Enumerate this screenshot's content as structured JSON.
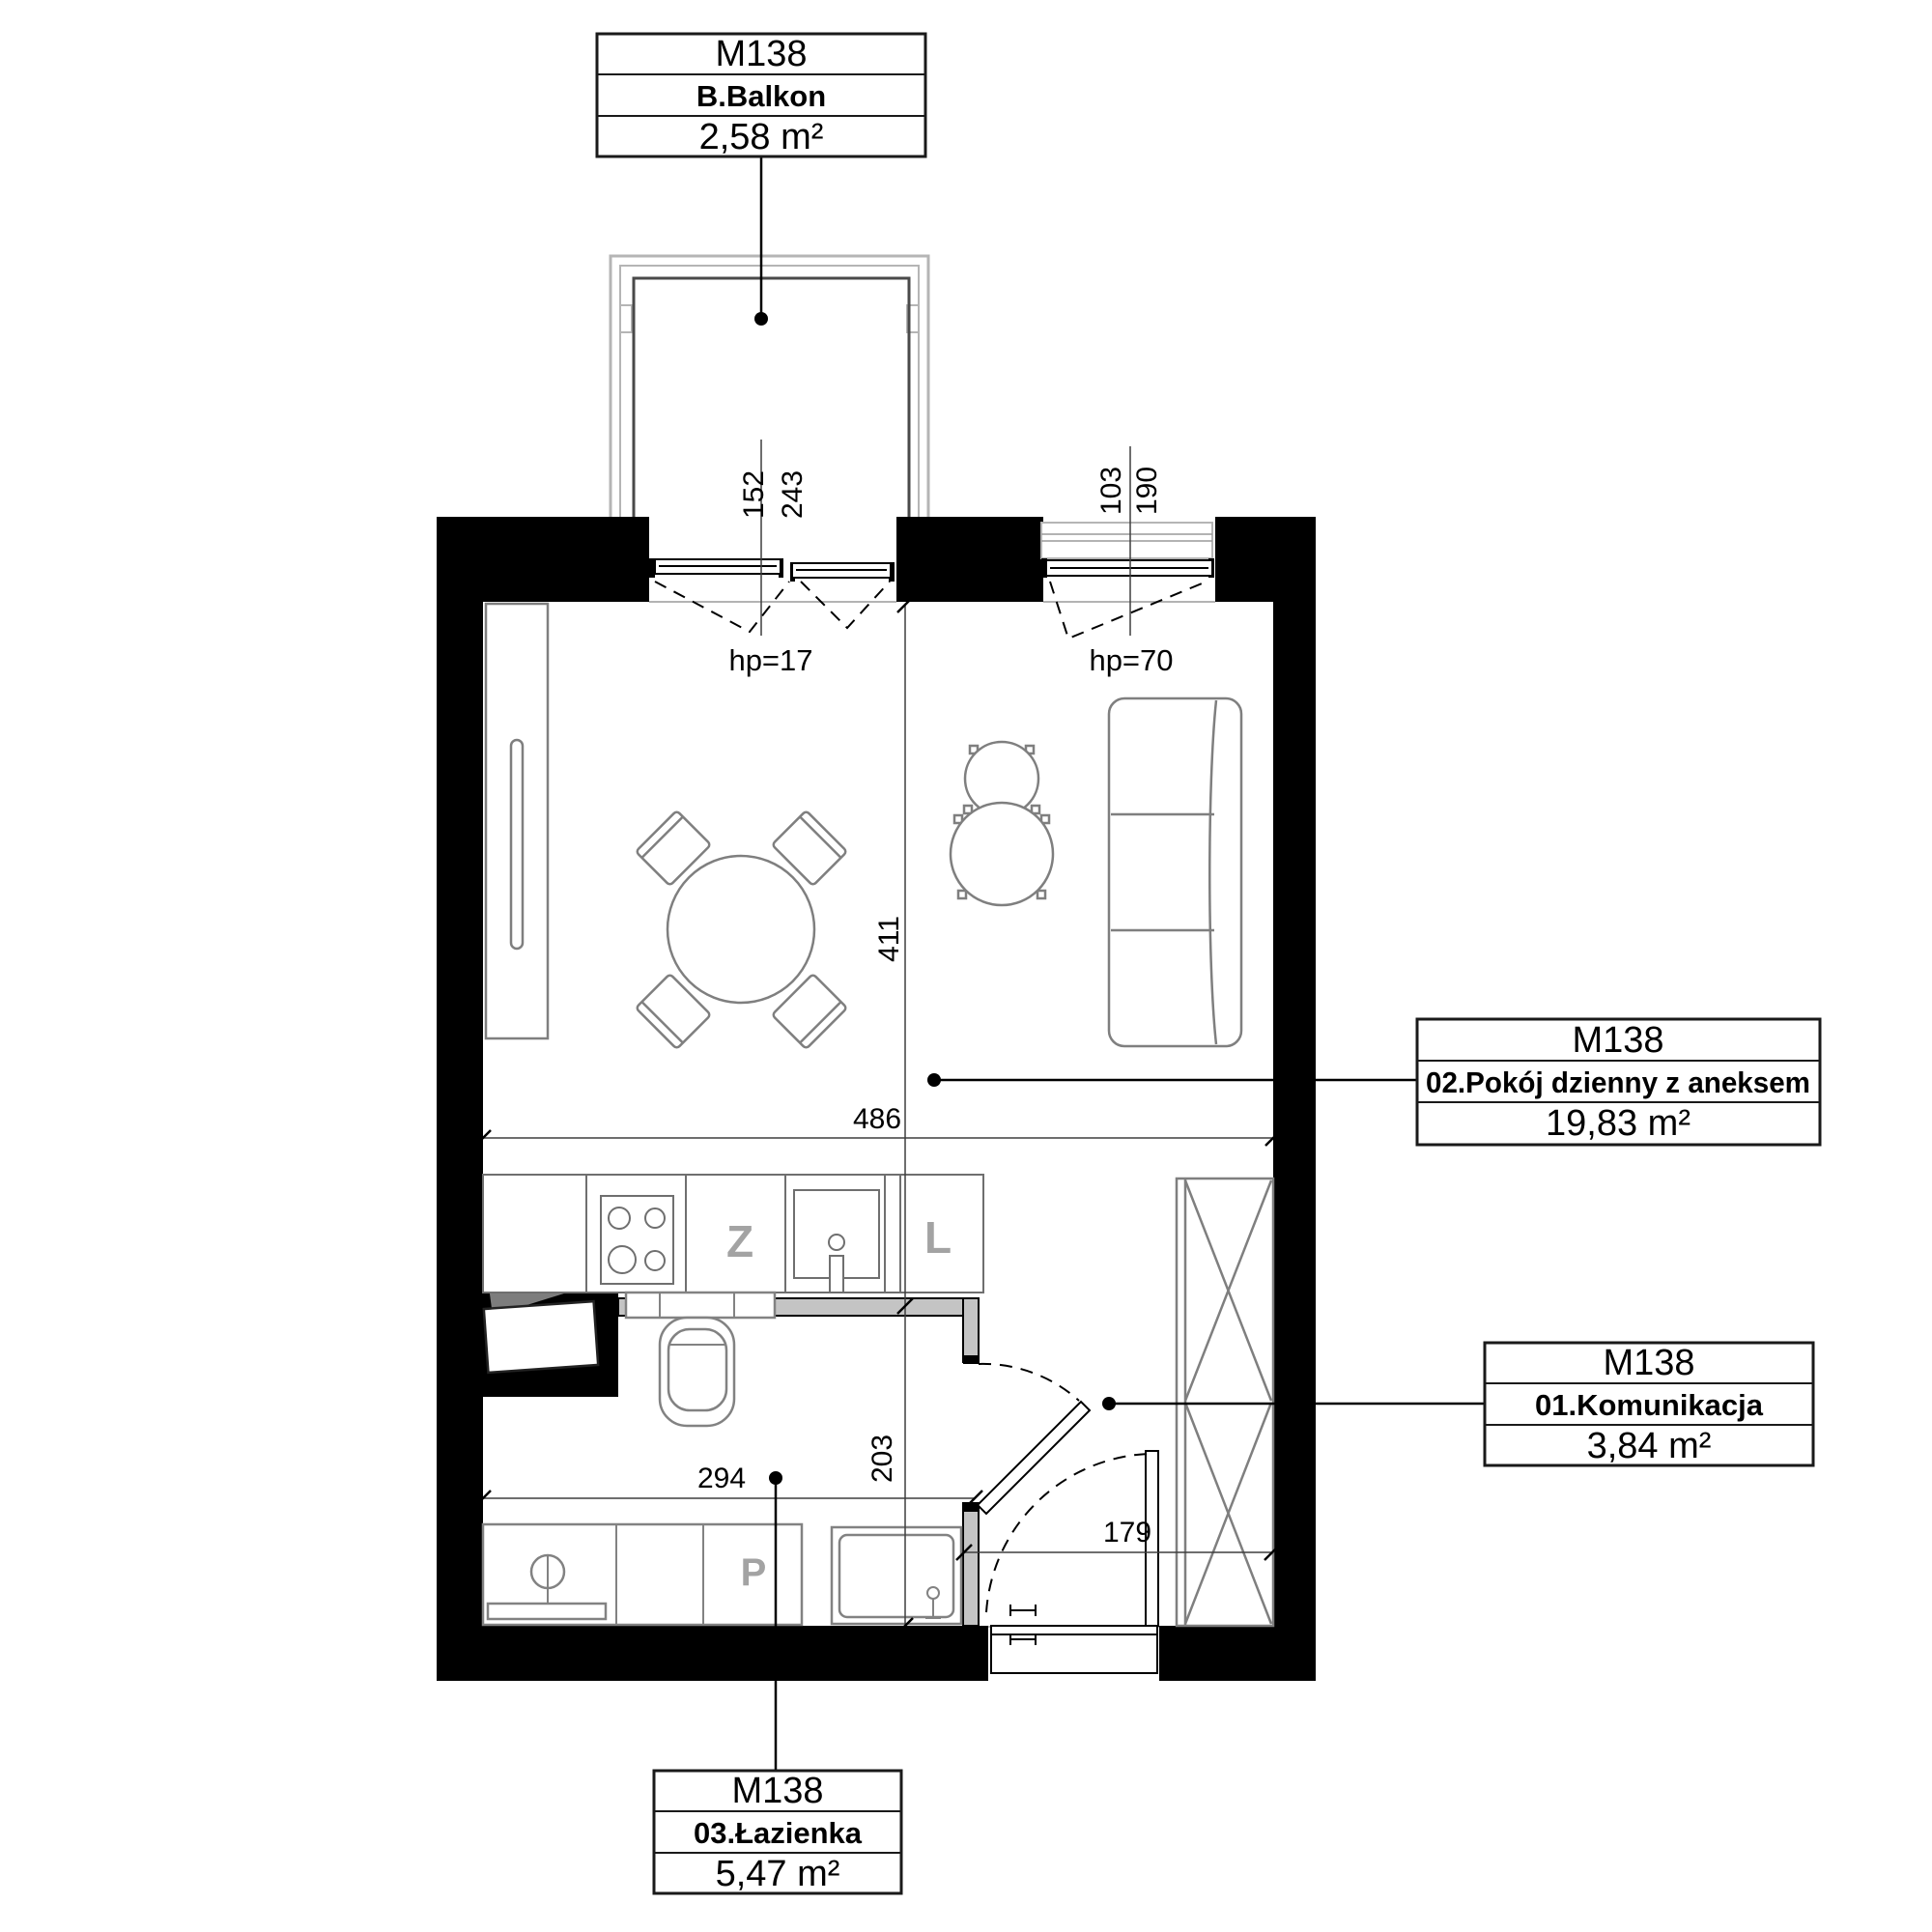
{
  "unit_label": "M138",
  "rooms": {
    "balcony": {
      "unit": "M138",
      "name": "B.Balkon",
      "area": "2,58 m²"
    },
    "living": {
      "unit": "M138",
      "name": "02.Pokój dzienny z aneksem",
      "area": "19,83 m²"
    },
    "hall": {
      "unit": "M138",
      "name": "01.Komunikacja",
      "area": "3,84 m²"
    },
    "bathroom": {
      "unit": "M138",
      "name": "03.Łazienka",
      "area": "5,47 m²"
    }
  },
  "dimensions": {
    "balcony_inner_width": "152",
    "balcony_outer_width": "243",
    "window_glass_width": "103",
    "window_width": "190",
    "living_depth": "411",
    "living_width": "486",
    "bathroom_width": "294",
    "bathroom_depth": "203",
    "hall_width": "179",
    "balcony_door_sill": "hp=17",
    "window_sill": "hp=70"
  },
  "symbols": {
    "sink": "Z",
    "fridge": "L",
    "washer": "P"
  },
  "colors": {
    "wall": "#000000",
    "partition_fill": "#c4c4c4",
    "furniture_stroke": "#7f7f7f",
    "kitchen_stroke": "#6f6f6f",
    "symbol_text": "#a3a3a3",
    "balcony_frame": "#b5b5b5",
    "dimension_line": "#3f3f3f",
    "text": "#000000",
    "background": "#ffffff"
  }
}
